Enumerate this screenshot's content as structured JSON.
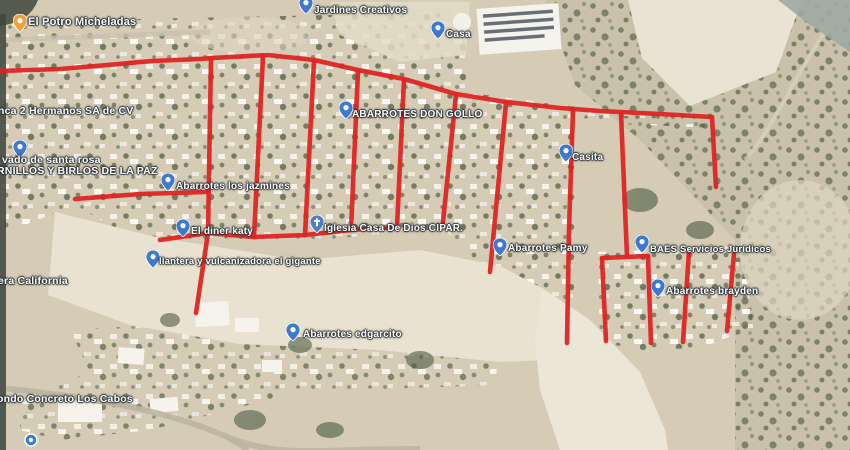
{
  "map": {
    "type": "satellite-imagery-with-street-annotations",
    "annotation": {
      "color": "#df2423",
      "stroke_width": 4.6,
      "polylines": {
        "top_boundary": [
          [
            0,
            71
          ],
          [
            60,
            69
          ],
          [
            96,
            66
          ],
          [
            152,
            61
          ],
          [
            200,
            59
          ],
          [
            212,
            58
          ],
          [
            268,
            55
          ],
          [
            314,
            60
          ],
          [
            358,
            70
          ],
          [
            404,
            79
          ],
          [
            456,
            94
          ],
          [
            506,
            102
          ],
          [
            560,
            108
          ],
          [
            600,
            111
          ],
          [
            660,
            114
          ],
          [
            712,
            117
          ],
          [
            716,
            187
          ]
        ],
        "west_street": [
          [
            75,
            199
          ],
          [
            140,
            194
          ],
          [
            207,
            192
          ]
        ],
        "street_v1": [
          [
            211,
            59
          ],
          [
            208,
            233
          ],
          [
            196,
            313
          ]
        ],
        "street_v2": [
          [
            263,
            56
          ],
          [
            254,
            237
          ]
        ],
        "street_v3": [
          [
            314,
            61
          ],
          [
            305,
            235
          ]
        ],
        "street_v4": [
          [
            358,
            71
          ],
          [
            351,
            230
          ]
        ],
        "street_v5": [
          [
            404,
            80
          ],
          [
            397,
            227
          ]
        ],
        "street_v6": [
          [
            456,
            95
          ],
          [
            443,
            222
          ]
        ],
        "street_v7": [
          [
            506,
            103
          ],
          [
            490,
            272
          ]
        ],
        "street_v8": [
          [
            573,
            110
          ],
          [
            569,
            230
          ],
          [
            567,
            343
          ]
        ],
        "street_v9": [
          [
            621,
            114
          ],
          [
            627,
            256
          ]
        ],
        "south_boundary": [
          [
            160,
            240
          ],
          [
            208,
            233
          ],
          [
            254,
            237
          ],
          [
            305,
            235
          ],
          [
            351,
            230
          ],
          [
            397,
            227
          ]
        ],
        "block_south_top": [
          [
            602,
            258
          ],
          [
            648,
            256
          ]
        ],
        "block_south_west": [
          [
            602,
            258
          ],
          [
            606,
            341
          ]
        ],
        "block_south_v1": [
          [
            648,
            256
          ],
          [
            651,
            343
          ]
        ],
        "block_south_v2": [
          [
            689,
            251
          ],
          [
            683,
            342
          ]
        ],
        "block_south_v3": [
          [
            734,
            254
          ],
          [
            727,
            331
          ]
        ]
      }
    },
    "pin_colors": {
      "place": "#3e79cf",
      "drink": "#efa23c",
      "church": "#4c7fc4",
      "circle": "#3a7bd5"
    },
    "labels": [
      {
        "id": "el-potro-micheladas",
        "text": "El Potro Micheladas",
        "x": 28,
        "y": 16,
        "size": 11,
        "pin": "drink",
        "pin_x": 20,
        "pin_y": 31
      },
      {
        "id": "jardines-creativos",
        "text": "Jardines Creativos",
        "x": 314,
        "y": 5,
        "pin": "place",
        "pin_x": 306,
        "pin_y": 13
      },
      {
        "id": "casa",
        "text": "Casa",
        "x": 446,
        "y": 29,
        "pin": "place",
        "pin_x": 438,
        "pin_y": 38
      },
      {
        "id": "abarrotes-don-gollo",
        "text": "ABARROTES DON GOLLO",
        "x": 352,
        "y": 109,
        "pin": "place",
        "pin_x": 346,
        "pin_y": 118
      },
      {
        "id": "casita",
        "text": "Casita",
        "x": 572,
        "y": 152,
        "pin": "place",
        "pin_x": 566,
        "pin_y": 161
      },
      {
        "id": "finca-2-hermanos",
        "text": "nca 2 Hermanos SA de CV",
        "x": -2,
        "y": 105,
        "size": 10.5,
        "pin": "none"
      },
      {
        "id": "lavado-de-santa-rosa",
        "text": "vado de santa rosa",
        "x": 2,
        "y": 154,
        "size": 10.5,
        "pin": "place",
        "pin_x": 20,
        "pin_y": 157
      },
      {
        "id": "tornillos-y-birlos-de-la-paz",
        "text": "RNILLOS Y BIRLOS DE LA PAZ",
        "x": -3,
        "y": 165,
        "size": 10.5,
        "pin": "none"
      },
      {
        "id": "abarrotes-los-jazmines",
        "text": "Abarrotes los jazmines",
        "x": 176,
        "y": 181,
        "pin": "place",
        "pin_x": 168,
        "pin_y": 190
      },
      {
        "id": "el-diner-katy",
        "text": "El diner katy",
        "x": 191,
        "y": 226,
        "pin": "place",
        "pin_x": 183,
        "pin_y": 236
      },
      {
        "id": "iglesia-casa-de-dios-cipar",
        "text": "Iglesia Casa De Dios CIPAR.",
        "x": 324,
        "y": 223,
        "pin": "church",
        "pin_x": 317,
        "pin_y": 232
      },
      {
        "id": "llantera-vulcanizadora-el-gigante",
        "text": "llantera y vulcanizadora el gigante",
        "x": 159,
        "y": 256,
        "size": 9.5,
        "pin": "place",
        "pin_x": 153,
        "pin_y": 267
      },
      {
        "id": "abarrotes-pamy",
        "text": "Abarrotes Pamy",
        "x": 508,
        "y": 243,
        "pin": "place",
        "pin_x": 500,
        "pin_y": 255
      },
      {
        "id": "baes-servicios-juridicos",
        "text": "BAES Servicios Jurídicos",
        "x": 650,
        "y": 244,
        "size": 9.5,
        "pin": "place",
        "pin_x": 642,
        "pin_y": 252
      },
      {
        "id": "abarrotes-brayden",
        "text": "Abarrotes brayden",
        "x": 666,
        "y": 286,
        "pin": "place",
        "pin_x": 658,
        "pin_y": 296
      },
      {
        "id": "abarrotes-edgarcito",
        "text": "Abarrotes edgarcito",
        "x": 303,
        "y": 329,
        "pin": "place",
        "pin_x": 293,
        "pin_y": 340
      },
      {
        "id": "era-california",
        "text": "era California",
        "x": -2,
        "y": 275,
        "size": 10.5,
        "pin": "none"
      },
      {
        "id": "ondo-concreto-los-cabos",
        "text": "ondo Concreto Los Cabos",
        "x": -3,
        "y": 393,
        "size": 10.5,
        "pin": "none"
      },
      {
        "id": "cropped-bottom-left-place",
        "text": "",
        "pin": "circle",
        "pin_x": 31,
        "pin_y": 446
      }
    ]
  }
}
